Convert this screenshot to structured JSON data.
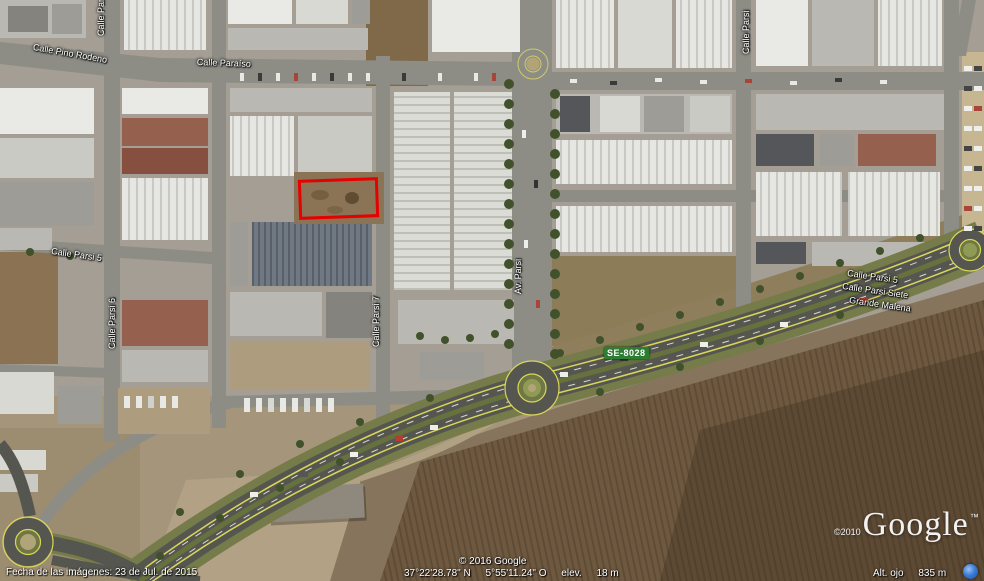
{
  "app_title": "Google Earth",
  "map": {
    "street_labels": [
      {
        "id": "calle-parsi-top-left",
        "text": "Calle Parsi"
      },
      {
        "id": "calle-pino-rodeno",
        "text": "Calle Pino Rodeno"
      },
      {
        "id": "calle-paraiso",
        "text": "Calle Paraíso"
      },
      {
        "id": "calle-parsi-top-right",
        "text": "Calle Parsi"
      },
      {
        "id": "calle-parsi-5",
        "text": "Calle Parsi 5"
      },
      {
        "id": "calle-parsi-6",
        "text": "Calle Parsi 6"
      },
      {
        "id": "calle-parsi-7",
        "text": "Calle Parsi 7"
      },
      {
        "id": "av-parsi",
        "text": "Av. Parsi"
      },
      {
        "id": "calle-parsi-5-east",
        "text": "Calle Parsi 5"
      },
      {
        "id": "calle-parsi-siete",
        "text": "Calle Parsi Siete"
      },
      {
        "id": "grande-malena",
        "text": "Grande Malena"
      }
    ],
    "route_badge": {
      "text": "SE-8028",
      "color": "#2e7d32"
    },
    "annotation": {
      "shape": "rectangle",
      "color": "#e60000"
    }
  },
  "logo": {
    "copyright": "©2010",
    "brand": "Google",
    "tm": "™"
  },
  "status_bar": {
    "imagery_date": "Fecha de las imágenes: 23 de Jul. de 2015",
    "copyright": "© 2016 Google",
    "latitude": "37°22'28.78\" N",
    "longitude": "5°55'11.24\" O",
    "elev_label": "elev.",
    "elevation": "18 m",
    "eye_alt_label": "Alt. ojo",
    "eye_altitude": "835 m"
  },
  "colors": {
    "annotation_red": "#e60000",
    "route_green": "#2e7d32",
    "status_icon_blue": "#3b7dd8",
    "highway_yellow": "#d9d75a",
    "grass_green": "#6f7845"
  }
}
